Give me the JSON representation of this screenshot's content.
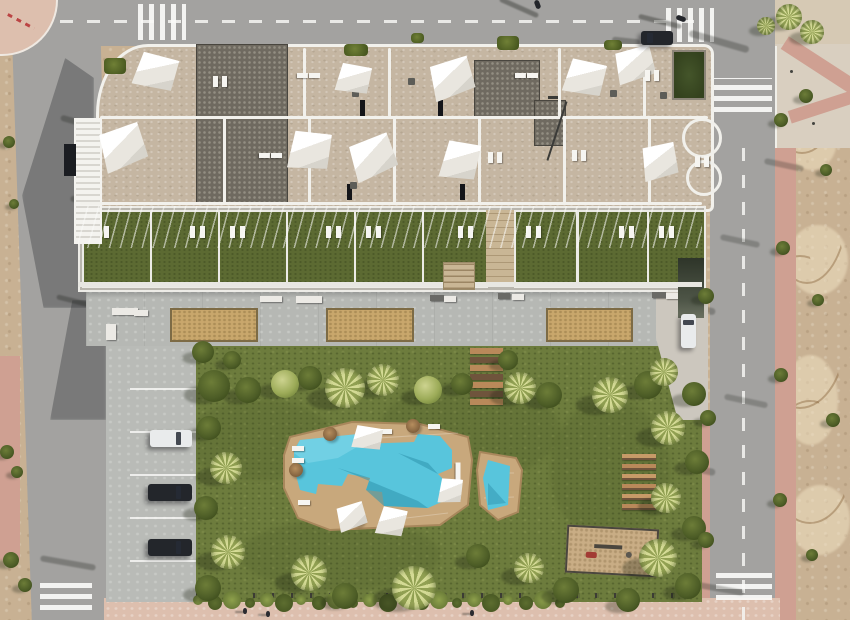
{
  "meta": {
    "description": "Aerial 3D render of a modern apartment complex: rooftop terraces with white shade sails, ground-floor lawn terraces, concrete promenade with two sand petanque courts, communal garden with free-form swimming pool and kids pool, wooden sun decks, playground, perpendicular parking with three cars, surrounding asphalt streets with zebra crossings, pink sidewalks and an undeveloped dirt lot on the right",
    "image_type": "architectural-aerial-render",
    "no_visible_text": true
  },
  "palette": {
    "dirt": "#c8b193",
    "road": "#a3a2a0",
    "pink": "#cfa092",
    "pinkLight": "#ddbfae",
    "plaza": "#d9cfc0",
    "roof": "#c5b6a2",
    "white": "#f2f1ec",
    "lawn": "#6d7c3d",
    "terraceLawn": "#5c6a32",
    "promenade": "#b6b8b4",
    "sand": "#c9a76c",
    "deck": "#c8a87c",
    "deckEdge": "#a8875c",
    "water": "#58c5dc",
    "waterLight": "#8adcec",
    "waterShadow": "#2f93ad",
    "wood": "#b9895a",
    "woodDark": "#6f543c",
    "carDark": "#23262b",
    "carWhite": "#e9ebec",
    "rampDark": "#4e5547"
  },
  "scene": {
    "sails": [
      [
        134,
        54,
        42,
        36,
        18
      ],
      [
        99,
        127,
        46,
        42,
        -16
      ],
      [
        336,
        64,
        34,
        30,
        14
      ],
      [
        429,
        60,
        44,
        38,
        -14
      ],
      [
        564,
        60,
        40,
        36,
        16
      ],
      [
        614,
        48,
        40,
        34,
        -12
      ],
      [
        288,
        131,
        42,
        40,
        10
      ],
      [
        349,
        138,
        46,
        40,
        -18
      ],
      [
        441,
        141,
        37,
        40,
        14
      ],
      [
        641,
        144,
        36,
        36,
        -8
      ]
    ],
    "poolSails": [
      [
        352,
        426,
        30,
        24,
        12
      ],
      [
        336,
        504,
        30,
        26,
        -14
      ],
      [
        377,
        507,
        28,
        30,
        16
      ],
      [
        438,
        478,
        24,
        26,
        8
      ]
    ],
    "trees": [
      [
        214,
        386,
        16,
        "d"
      ],
      [
        248,
        390,
        13,
        "d"
      ],
      [
        285,
        384,
        14,
        "l"
      ],
      [
        310,
        378,
        12,
        "d"
      ],
      [
        345,
        388,
        20,
        "p"
      ],
      [
        383,
        380,
        16,
        "p"
      ],
      [
        428,
        390,
        14,
        "l"
      ],
      [
        462,
        384,
        11,
        "d"
      ],
      [
        508,
        360,
        10,
        "d"
      ],
      [
        520,
        388,
        16,
        "p"
      ],
      [
        549,
        395,
        13,
        "d"
      ],
      [
        610,
        395,
        18,
        "p"
      ],
      [
        648,
        385,
        14,
        "d"
      ],
      [
        209,
        428,
        12,
        "d"
      ],
      [
        226,
        468,
        16,
        "p"
      ],
      [
        206,
        508,
        12,
        "d"
      ],
      [
        228,
        552,
        17,
        "p"
      ],
      [
        208,
        588,
        13,
        "d"
      ],
      [
        664,
        372,
        14,
        "p"
      ],
      [
        694,
        394,
        12,
        "d"
      ],
      [
        668,
        428,
        17,
        "p"
      ],
      [
        697,
        462,
        12,
        "d"
      ],
      [
        666,
        498,
        15,
        "p"
      ],
      [
        694,
        528,
        12,
        "d"
      ],
      [
        658,
        558,
        19,
        "p"
      ],
      [
        688,
        586,
        13,
        "d"
      ],
      [
        628,
        600,
        12,
        "d"
      ],
      [
        309,
        573,
        18,
        "p"
      ],
      [
        345,
        596,
        13,
        "d"
      ],
      [
        414,
        588,
        22,
        "p"
      ],
      [
        478,
        556,
        12,
        "d"
      ],
      [
        529,
        568,
        15,
        "p"
      ],
      [
        566,
        590,
        13,
        "d"
      ],
      [
        203,
        352,
        11,
        "d"
      ],
      [
        232,
        360,
        9,
        "d"
      ],
      [
        706,
        296,
        8,
        "d"
      ],
      [
        708,
        418,
        8,
        "d"
      ],
      [
        706,
        540,
        8,
        "d"
      ],
      [
        781,
        120,
        7,
        "d"
      ],
      [
        783,
        248,
        7,
        "d"
      ],
      [
        781,
        375,
        7,
        "d"
      ],
      [
        780,
        500,
        7,
        "d"
      ],
      [
        789,
        17,
        13,
        "p"
      ],
      [
        812,
        32,
        12,
        "p"
      ],
      [
        766,
        26,
        9,
        "p"
      ],
      [
        9,
        142,
        6,
        "d"
      ],
      [
        14,
        204,
        5,
        "d"
      ],
      [
        7,
        452,
        7,
        "d"
      ],
      [
        17,
        472,
        6,
        "d"
      ],
      [
        11,
        560,
        8,
        "d"
      ],
      [
        25,
        585,
        7,
        "d"
      ],
      [
        806,
        96,
        7,
        "d"
      ],
      [
        826,
        170,
        6,
        "d"
      ],
      [
        818,
        300,
        6,
        "d"
      ],
      [
        833,
        420,
        7,
        "d"
      ],
      [
        812,
        555,
        6,
        "d"
      ]
    ],
    "roofPatches": [
      [
        196,
        44,
        90,
        158,
        "dark"
      ],
      [
        474,
        60,
        64,
        56,
        "dark"
      ],
      [
        534,
        100,
        30,
        44,
        "dark"
      ],
      [
        672,
        50,
        30,
        46,
        "green"
      ]
    ],
    "roofSlots": [
      [
        360,
        100
      ],
      [
        438,
        100
      ],
      [
        347,
        184
      ],
      [
        460,
        184
      ]
    ],
    "roofPlanters": [
      [
        344,
        44,
        24,
        12
      ],
      [
        497,
        36,
        22,
        14
      ],
      [
        411,
        33,
        13,
        10
      ],
      [
        604,
        40,
        18,
        10
      ],
      [
        104,
        58,
        22,
        16
      ]
    ],
    "roofLines": {
      "h": [
        [
          100,
          116,
          608
        ],
        [
          80,
          202,
          622
        ]
      ],
      "v": [
        [
          303,
          48,
          70
        ],
        [
          388,
          48,
          70
        ],
        [
          558,
          48,
          70
        ],
        [
          643,
          48,
          70
        ],
        [
          223,
          118,
          86
        ],
        [
          308,
          118,
          86
        ],
        [
          393,
          118,
          86
        ],
        [
          478,
          118,
          86
        ],
        [
          563,
          118,
          86
        ],
        [
          648,
          118,
          86
        ]
      ]
    },
    "roofLoungers": [
      [
        213,
        76,
        0
      ],
      [
        222,
        76,
        0
      ],
      [
        262,
        150,
        90
      ],
      [
        274,
        150,
        90
      ],
      [
        518,
        70,
        90
      ],
      [
        530,
        70,
        90
      ],
      [
        572,
        150,
        0
      ],
      [
        581,
        150,
        0
      ],
      [
        695,
        156,
        0
      ],
      [
        704,
        156,
        0
      ],
      [
        300,
        70,
        90
      ],
      [
        312,
        70,
        90
      ],
      [
        645,
        70,
        0
      ],
      [
        654,
        70,
        0
      ],
      [
        488,
        152,
        0
      ],
      [
        497,
        152,
        0
      ]
    ],
    "roofProps": [
      [
        352,
        90
      ],
      [
        408,
        78
      ],
      [
        298,
        158
      ],
      [
        455,
        158
      ],
      [
        610,
        90
      ],
      [
        350,
        182
      ],
      [
        660,
        92
      ]
    ],
    "terraceRow": {
      "x": 78,
      "y": 206,
      "w": 624,
      "h": 82,
      "unitY": 2,
      "unitH": 74,
      "units": [
        [
          2,
          66
        ],
        [
          70,
          66
        ],
        [
          138,
          66
        ],
        [
          206,
          66
        ],
        [
          274,
          66
        ],
        [
          342,
          62
        ],
        [
          434,
          60
        ],
        [
          497,
          68
        ],
        [
          567,
          55
        ]
      ],
      "passage": [
        406,
        28
      ]
    },
    "steps": [
      443,
      262,
      30,
      26
    ],
    "courts": [
      [
        170,
        308,
        84,
        30
      ],
      [
        326,
        308,
        84,
        30
      ],
      [
        546,
        308,
        83,
        30
      ]
    ],
    "benches": [
      [
        112,
        308,
        26,
        7,
        "w"
      ],
      [
        134,
        310,
        14,
        6,
        "w"
      ],
      [
        106,
        324,
        10,
        16,
        "w"
      ],
      [
        260,
        296,
        22,
        6,
        "w"
      ],
      [
        296,
        296,
        26,
        7,
        "w"
      ],
      [
        430,
        295,
        14,
        6,
        "g"
      ],
      [
        444,
        296,
        12,
        6,
        "w"
      ],
      [
        498,
        293,
        12,
        6,
        "g"
      ],
      [
        512,
        294,
        12,
        6,
        "w"
      ],
      [
        652,
        292,
        14,
        6,
        "g"
      ],
      [
        666,
        293,
        12,
        6,
        "w"
      ]
    ],
    "stairPlanks": {
      "x": 470,
      "y": 348,
      "w": 33,
      "h": 6,
      "gap": 2.5,
      "count": 7
    },
    "deckPlanks": {
      "x": 622,
      "y": 454,
      "w": 34,
      "h": 6,
      "gap": 4,
      "count": 6
    },
    "playground": [
      566,
      527,
      88,
      44,
      3
    ],
    "hedge": {
      "x0": 198,
      "x1": 560,
      "y": 600,
      "count": 22
    },
    "parking": {
      "slab": [
        106,
        346,
        90,
        256
      ],
      "lineYs": [
        388,
        431,
        474,
        517,
        560
      ],
      "cars": [
        [
          150,
          430,
          42,
          17,
          "white"
        ],
        [
          148,
          484,
          44,
          17,
          "dark"
        ],
        [
          148,
          539,
          44,
          17,
          "dark"
        ]
      ]
    },
    "ramp": {
      "strip": [
        678,
        258,
        26,
        60
      ],
      "car": [
        681,
        314,
        15,
        34
      ]
    },
    "roadCars": [
      [
        641,
        31,
        32,
        14
      ]
    ],
    "bikes": [
      [
        533,
        2,
        9,
        5,
        70
      ],
      [
        676,
        16,
        10,
        5,
        20
      ]
    ],
    "crosswalks": [
      [
        138,
        4,
        48,
        36,
        "v"
      ],
      [
        666,
        8,
        48,
        34,
        "v"
      ],
      [
        714,
        78,
        58,
        34,
        "h"
      ],
      [
        716,
        568,
        56,
        32,
        "h"
      ],
      [
        40,
        577,
        52,
        33,
        "h"
      ]
    ],
    "dashLines": [
      [
        60,
        20,
        640,
        2.5,
        "h"
      ],
      [
        742,
        134,
        2.5,
        486,
        "v"
      ]
    ],
    "streaks": [
      [
        652,
        302,
        64,
        7,
        12,
        0.28
      ],
      [
        646,
        462,
        70,
        7,
        12,
        0.26
      ],
      [
        606,
        128,
        84,
        8,
        10,
        0.3
      ],
      [
        688,
        38,
        62,
        7,
        16,
        0.3
      ],
      [
        498,
        5,
        42,
        5,
        24,
        0.38
      ],
      [
        638,
        19,
        44,
        5,
        14,
        0.38
      ],
      [
        612,
        38,
        28,
        6,
        6,
        0.3
      ],
      [
        116,
        352,
        62,
        6,
        -10,
        0.26
      ],
      [
        112,
        470,
        68,
        6,
        -10,
        0.24
      ],
      [
        114,
        556,
        62,
        6,
        -10,
        0.24
      ],
      [
        56,
        300,
        48,
        5,
        14,
        0.32
      ],
      [
        40,
        560,
        56,
        6,
        10,
        0.3
      ],
      [
        698,
        586,
        46,
        6,
        10,
        0.28
      ],
      [
        764,
        162,
        40,
        6,
        12,
        0.25
      ],
      [
        60,
        120,
        40,
        6,
        16,
        0.3
      ],
      [
        70,
        200,
        46,
        6,
        12,
        0.3
      ],
      [
        720,
        238,
        40,
        6,
        12,
        0.25
      ],
      [
        724,
        398,
        44,
        6,
        12,
        0.24
      ],
      [
        333,
        448,
        26,
        12,
        14,
        0.15
      ],
      [
        356,
        520,
        24,
        10,
        -10,
        0.15
      ],
      [
        393,
        522,
        22,
        12,
        12,
        0.15
      ]
    ],
    "figures": [
      [
        243,
        608
      ],
      [
        266,
        611
      ],
      [
        470,
        610
      ]
    ],
    "poolLoungers": [
      [
        292,
        446,
        0
      ],
      [
        292,
        458,
        0
      ],
      [
        298,
        500,
        0
      ],
      [
        363,
        429,
        0
      ],
      [
        380,
        429,
        0
      ],
      [
        452,
        466,
        90
      ],
      [
        452,
        478,
        90
      ],
      [
        428,
        424,
        0
      ]
    ],
    "parasols": [
      [
        330,
        434
      ],
      [
        357,
        519
      ],
      [
        389,
        517
      ],
      [
        413,
        426
      ],
      [
        296,
        470
      ]
    ],
    "bollards": [
      [
        790,
        70
      ],
      [
        800,
        96
      ],
      [
        812,
        122
      ]
    ],
    "blotches": [
      [
        260,
        440,
        150,
        80
      ],
      [
        470,
        430,
        180,
        100
      ],
      [
        340,
        555,
        200,
        70
      ],
      [
        610,
        470,
        120,
        140
      ]
    ],
    "mounds": [
      [
        812,
        140,
        50,
        60
      ],
      [
        818,
        260,
        60,
        70
      ],
      [
        810,
        400,
        55,
        90
      ],
      [
        820,
        520,
        60,
        70
      ]
    ],
    "ridges": [
      [
        800,
        90,
        70,
        120
      ],
      [
        805,
        200,
        80,
        160
      ],
      [
        798,
        330,
        90,
        150
      ],
      [
        808,
        460,
        80,
        120
      ]
    ]
  }
}
